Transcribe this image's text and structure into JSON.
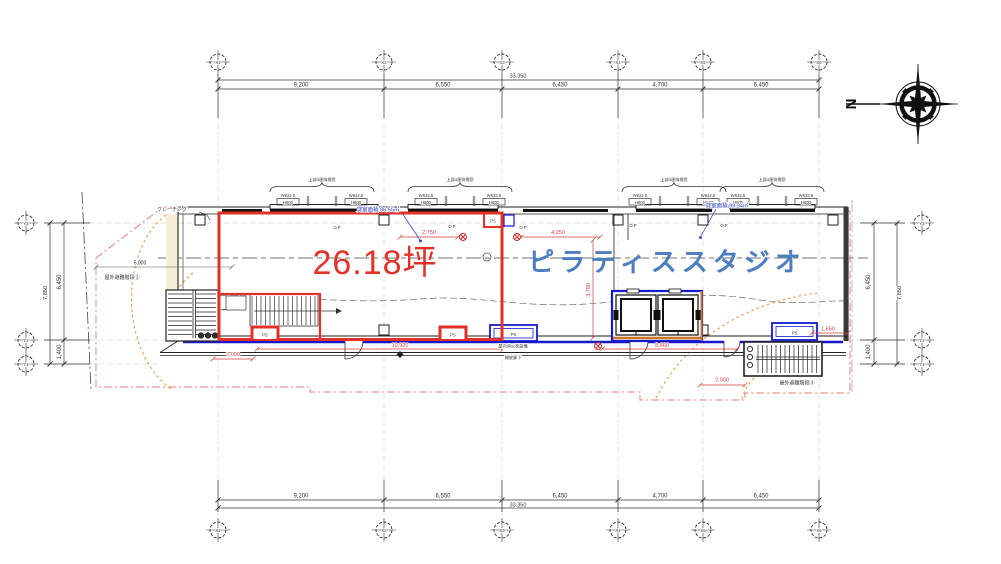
{
  "compass": {
    "north": "N"
  },
  "grid_x": {
    "bubbles": [
      "X1",
      "X2",
      "X3",
      "X4",
      "X5",
      "X6"
    ]
  },
  "grid_y": {
    "bubbles": [
      "Y3",
      "Y2",
      "Y1"
    ]
  },
  "dims": {
    "top": {
      "segments": [
        "9,200",
        "6,550",
        "6,450",
        "4,700",
        "6,450"
      ],
      "total": "33,350"
    },
    "bottom": {
      "segments": [
        "9,200",
        "6,550",
        "6,450",
        "4,700",
        "6,450"
      ],
      "total": "33,350"
    },
    "left": {
      "segments": [
        "6,450",
        "1,400"
      ],
      "total": "7,850"
    },
    "right": {
      "segments": [
        "6,450",
        "1,400"
      ],
      "total": "7,850"
    },
    "red": {
      "w2750": "2,750",
      "w4250": "4,250",
      "h3780": "3,780",
      "w10920": "10,920",
      "w8660": "8,660",
      "w1650": "1,650",
      "w2000a": "2,000",
      "w2000b": "2,000"
    },
    "site": {
      "w5000": "5,000"
    }
  },
  "tenant": {
    "area_tsubo": "26.18坪",
    "area_note": "貸室面積 86.55㎡"
  },
  "studio": {
    "name": "ピラティススタジオ",
    "area_note": "貸室面積 99.34㎡"
  },
  "labels": {
    "grating": "グレーチング",
    "stair_left": "屋外避難階段②",
    "stair_right": "屋外避難階段③",
    "fire_hydrant": "屋内消火栓設備",
    "open_corridor": "開放廊下",
    "op": "O.P",
    "ps": "PS",
    "window_note": "上部4連排煙窓",
    "window_width": "W622.5",
    "window_height": "H600",
    "window_mark": "H"
  }
}
